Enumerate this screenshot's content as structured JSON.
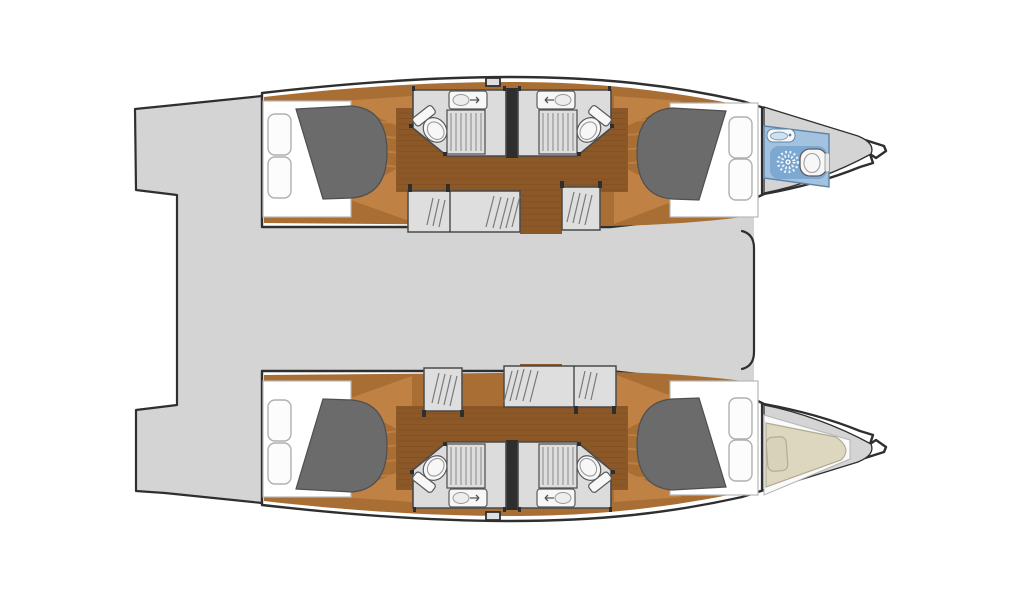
{
  "page": {
    "title": "Catamaran interior layout floor plan",
    "background": "#ffffff"
  },
  "colors": {
    "deck": "#d4d4d4",
    "outline": "#2f2f2f",
    "hull_white": "#ffffff",
    "wood_light": "#c08145",
    "wood_mid": "#a96e33",
    "wood_dark": "#8d5827",
    "plank_line": "#7a4a1f",
    "mattress": "#6b6b6b",
    "mattress_outline": "#4f4f4f",
    "pillow": "#fcfcfc",
    "pillow_outline": "#b0b0b0",
    "bath_floor": "#dcdcdc",
    "bath_outline": "#4a4a4a",
    "grate_line": "#909090",
    "fixture_white": "#f7f7f7",
    "fixture_outline": "#5a5a5a",
    "partition": "#2e2e2e",
    "head_blue": "#a3c2e0",
    "head_blue_dark": "#7da8d2",
    "head_blue_outline": "#5f84a8",
    "sink_blue": "#cfe0ef",
    "berth_tan": "#ded7c0",
    "berth_pillow": "#d9d2ba",
    "berth_outline": "#b3ac93",
    "white_floor": "#fafafa",
    "step_fill": "#dedede",
    "hatch_line": "#7a7a7a",
    "bed_base": "#ffffff",
    "bed_base_outline": "#b8b8b8",
    "page_bg": "#ffffff"
  },
  "plan": {
    "vessel_type": "catamaran",
    "view": "top-down interior deck plan",
    "orientation": "bows-right, transoms-left",
    "hulls": [
      {
        "id": "port-hull",
        "position": "top",
        "rooms": [
          {
            "name": "aft-cabin",
            "furniture": [
              "double-berth-mattress",
              "two-pillows",
              "wood-floor"
            ]
          },
          {
            "name": "aft-head",
            "fixtures": [
              "toilet",
              "washbasin",
              "shower-grate"
            ]
          },
          {
            "name": "forward-head",
            "fixtures": [
              "toilet",
              "washbasin",
              "shower-grate"
            ]
          },
          {
            "name": "forward-cabin",
            "furniture": [
              "double-berth-mattress",
              "two-pillows",
              "wood-floor"
            ]
          },
          {
            "name": "bow-head",
            "floor": "blue",
            "fixtures": [
              "shower-rose",
              "toilet",
              "washbasin"
            ]
          }
        ]
      },
      {
        "id": "starboard-hull",
        "position": "bottom",
        "rooms": [
          {
            "name": "aft-cabin",
            "furniture": [
              "double-berth-mattress",
              "two-pillows",
              "wood-floor"
            ]
          },
          {
            "name": "aft-head",
            "fixtures": [
              "toilet",
              "washbasin",
              "shower-grate"
            ]
          },
          {
            "name": "forward-head",
            "fixtures": [
              "toilet",
              "washbasin",
              "shower-grate"
            ]
          },
          {
            "name": "forward-cabin",
            "furniture": [
              "double-berth-mattress",
              "two-pillows",
              "wood-floor"
            ]
          },
          {
            "name": "forepeak-berth",
            "furniture": [
              "tapered-berth",
              "pillow",
              "white-floor"
            ]
          }
        ]
      }
    ],
    "deck_areas": [
      "transom-step-port",
      "transom-step-starboard",
      "aft-cockpit",
      "bridgedeck-saloon"
    ],
    "details": [
      "companionway-steps-in-each-hull",
      "central-partition-between-heads",
      "deck-cleat-on-each-hull",
      "open-trampoline-area-between-bows"
    ]
  }
}
